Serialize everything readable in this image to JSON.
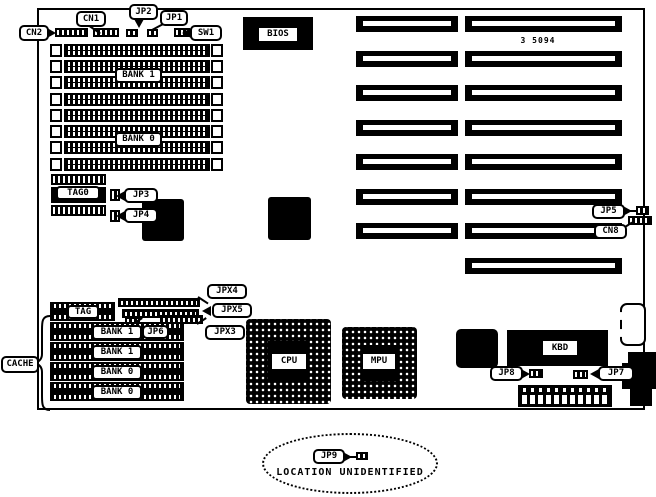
{
  "diagram": {
    "part_number": "3 5094",
    "note": "LOCATION UNIDENTIFIED"
  },
  "callouts": {
    "cn2": "CN2",
    "cn1": "CN1",
    "jp2": "JP2",
    "jp1": "JP1",
    "sw1": "SW1",
    "jp3": "JP3",
    "jp4": "JP4",
    "jp5": "JP5",
    "cn8": "CN8",
    "jpx4": "JPX4",
    "jpx5": "JPX5",
    "jpx3": "JPX3",
    "jp6": "JP6",
    "cache": "CACHE",
    "jp8": "JP8",
    "jp7": "JP7",
    "jp9": "JP9"
  },
  "chips": {
    "bios": "BIOS",
    "tag0": "TAG0",
    "cpu": "CPU",
    "mpu": "MPU",
    "kbd": "KBD"
  },
  "memory": {
    "simm_bank1": "BANK 1",
    "simm_bank0": "BANK 0",
    "cache_tag": "TAG",
    "cache_bank1_row1": "BANK 1",
    "cache_bank1_row2": "BANK 1",
    "cache_bank0_row1": "BANK 0",
    "cache_bank0_row2": "BANK 0"
  }
}
